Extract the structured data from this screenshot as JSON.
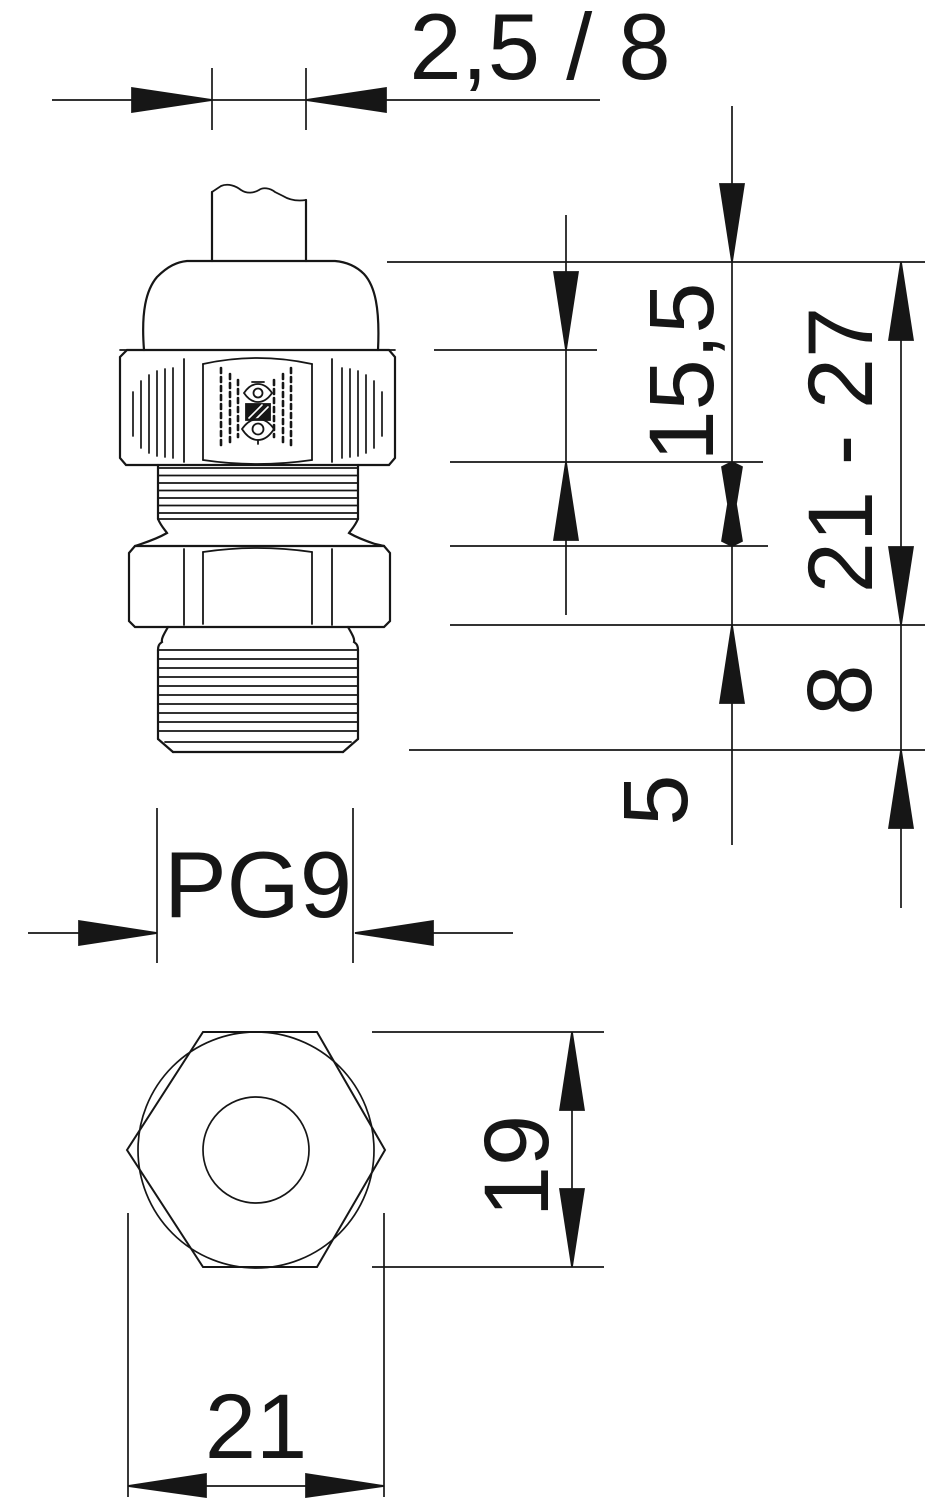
{
  "title": "PG9 cable gland dimensional drawing",
  "labels": {
    "cable_clamp_range": "2,5 / 8",
    "upper_part_height": "15,5",
    "overall_height_range": "21 - 27",
    "thread_length": "8",
    "below_thread": "5",
    "thread_size": "PG9",
    "across_flats": "19",
    "across_corners": "21"
  },
  "colors": {
    "line": "#161616",
    "background": "#ffffff"
  }
}
